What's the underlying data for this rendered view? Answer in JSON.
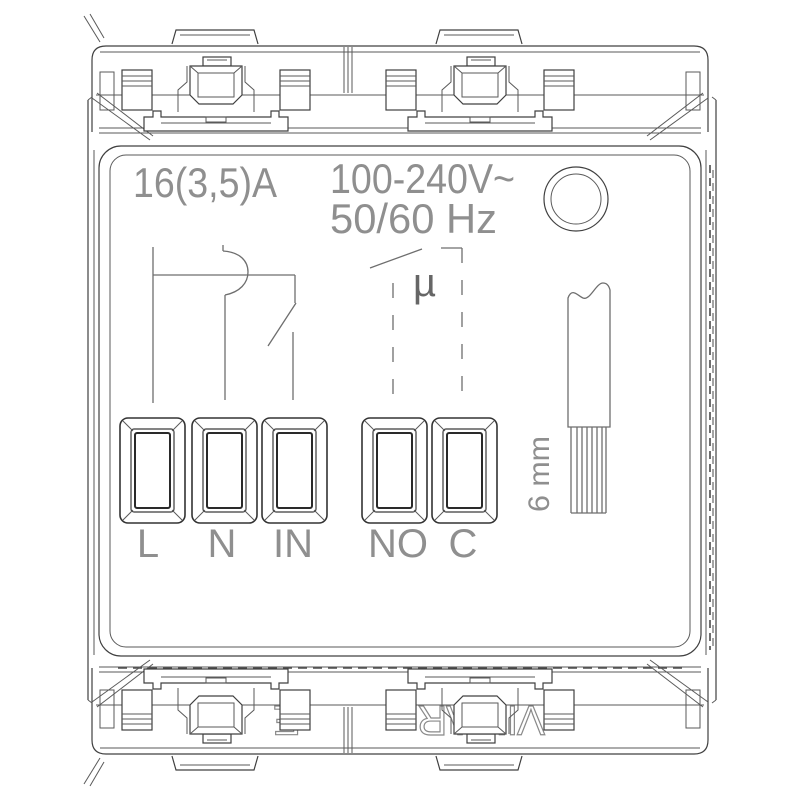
{
  "drawing": {
    "kind": "electrical-device-rear-view-technical-drawing",
    "ratings": {
      "current": "16(3,5)A",
      "voltage": "100-240V~",
      "frequency": "50/60 Hz"
    },
    "symbols": {
      "micro_disconnection": "µ"
    },
    "terminals": [
      {
        "label": "L"
      },
      {
        "label": "N"
      },
      {
        "label": "IN"
      },
      {
        "label": "NO"
      },
      {
        "label": "C"
      }
    ],
    "wire_strip": {
      "length_label": "6 mm"
    },
    "embossed": {
      "brand": "VIMAR",
      "fragment": "E"
    },
    "colors": {
      "line": "#404040",
      "schematic_line": "#6e6e6e",
      "cad_text": "#8f8f8f",
      "emboss_line": "#8a8a8a",
      "background": "#ffffff"
    }
  }
}
